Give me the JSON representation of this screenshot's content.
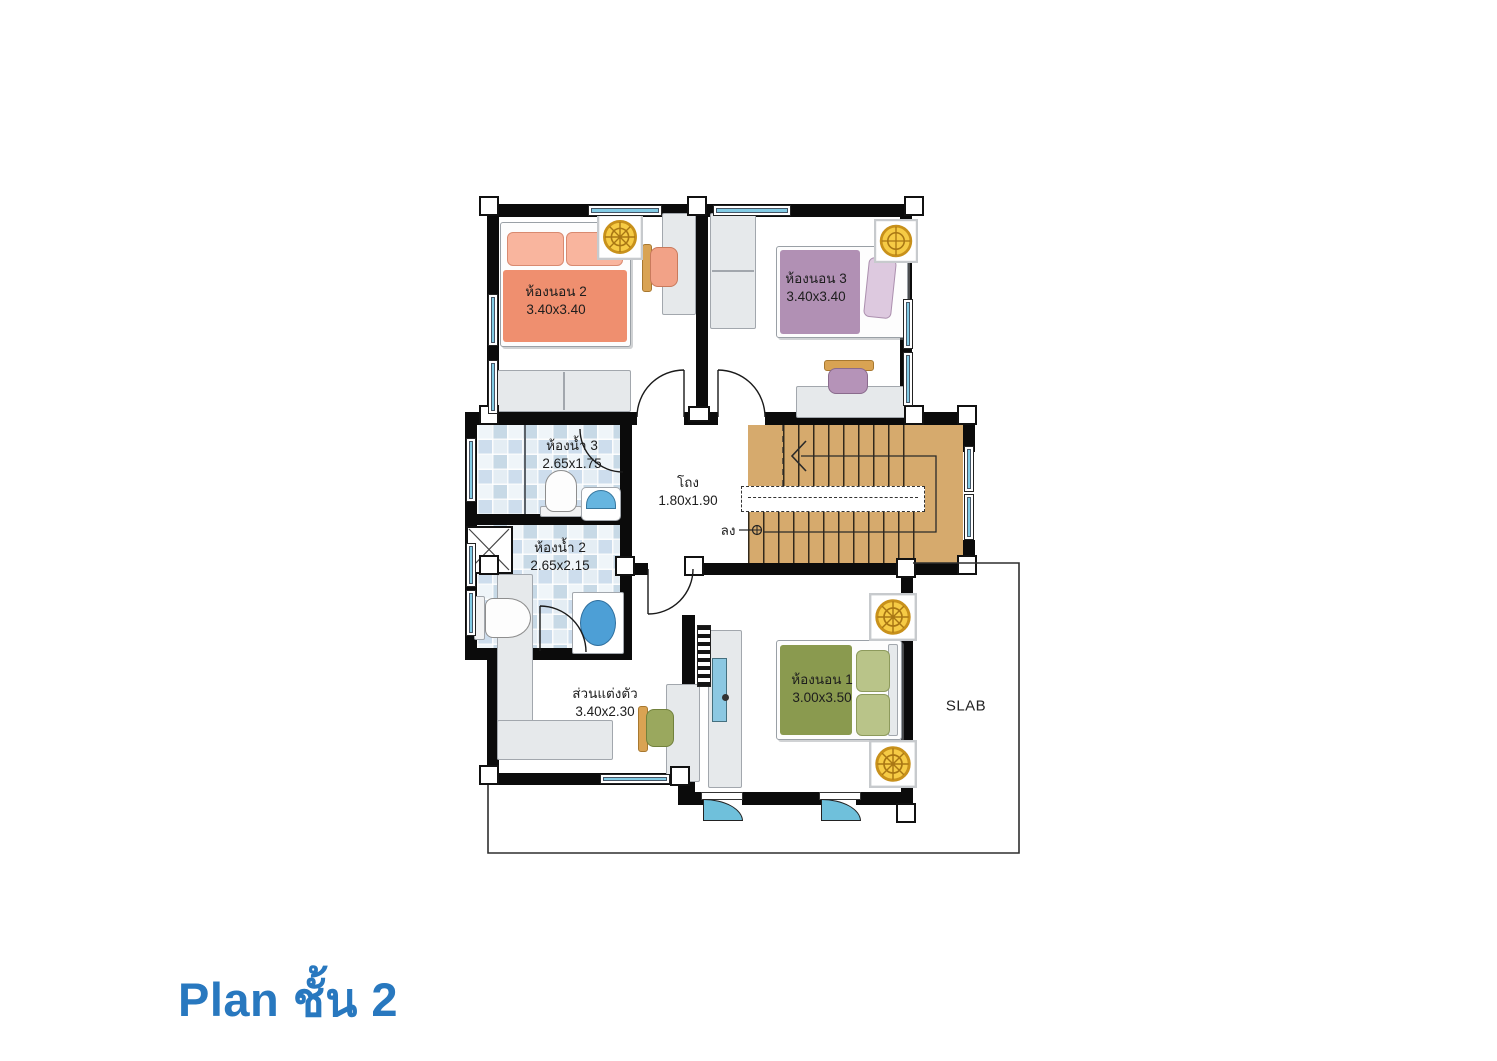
{
  "title": "Plan ชั้น 2",
  "plan": {
    "rooms": {
      "bedroom2": {
        "name": "ห้องนอน 2",
        "dims": "3.40x3.40"
      },
      "bedroom3": {
        "name": "ห้องนอน 3",
        "dims": "3.40x3.40"
      },
      "bath3": {
        "name": "ห้องน้ำ 3",
        "dims": "2.65x1.75"
      },
      "bath2": {
        "name": "ห้องน้ำ 2",
        "dims": "2.65x2.15"
      },
      "hall": {
        "name": "โถง",
        "dims": "1.80x1.90"
      },
      "dressing": {
        "name": "ส่วนแต่งตัว",
        "dims": "3.40x2.30"
      },
      "bedroom1": {
        "name": "ห้องนอน 1",
        "dims": "3.00x3.50"
      },
      "slab": {
        "name": "SLAB"
      }
    },
    "stairs": {
      "down_label": "ลง"
    },
    "colors": {
      "title_blue": "#2878bf",
      "wall_black": "#0b0b0b",
      "stair_tan": "#d6aa6d",
      "window_blue": "#82cbe4",
      "bed2_salmon": "#ef8f6f",
      "bed3_purple": "#b190b4",
      "bed1_olive": "#8a9a4f",
      "tile_blue": "#c7d9e6",
      "lamp_gold": "#f6cb45"
    }
  }
}
